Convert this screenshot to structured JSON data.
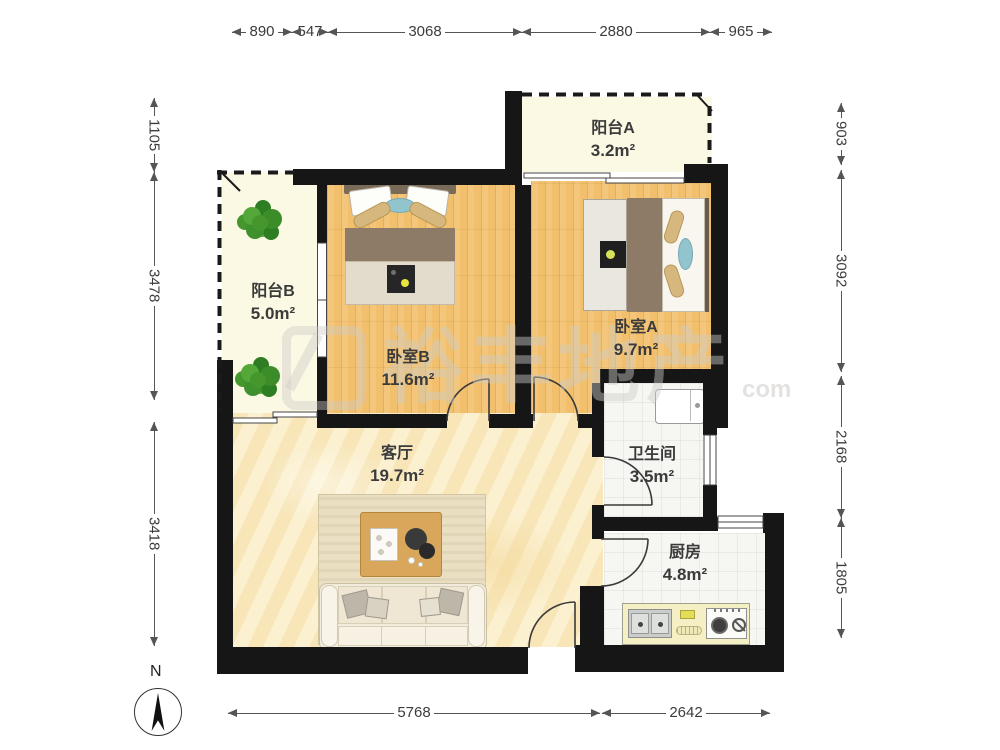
{
  "rooms": {
    "balcony_a": {
      "name": "阳台A",
      "area": "3.2m²"
    },
    "balcony_b": {
      "name": "阳台B",
      "area": "5.0m²"
    },
    "bedroom_b": {
      "name": "卧室B",
      "area": "11.6m²"
    },
    "bedroom_a": {
      "name": "卧室A",
      "area": "9.7m²"
    },
    "living_room": {
      "name": "客厅",
      "area": "19.7m²"
    },
    "bathroom": {
      "name": "卫生间",
      "area": "3.5m²"
    },
    "kitchen": {
      "name": "厨房",
      "area": "4.8m²"
    }
  },
  "dimensions": {
    "top": [
      "890",
      "547",
      "3068",
      "2880",
      "965"
    ],
    "left": [
      "1105",
      "3478",
      "3418"
    ],
    "right": [
      "903",
      "3092",
      "2168",
      "1805"
    ],
    "bottom": [
      "5768",
      "2642"
    ]
  },
  "compass": {
    "north_label": "N"
  },
  "watermark": {
    "text": "裕丰地产",
    "suffix": "com"
  },
  "colors": {
    "wall": "#161616",
    "wood_floor": "#F2C06C",
    "living_floor": "#FAEDC7",
    "balcony_floor": "#FBF8E3",
    "tile_floor": "#F6F6F2",
    "accent_blue_pillow": "#92C4CE",
    "blanket_brown": "#8D7B67",
    "plant_green": "#46962e"
  }
}
